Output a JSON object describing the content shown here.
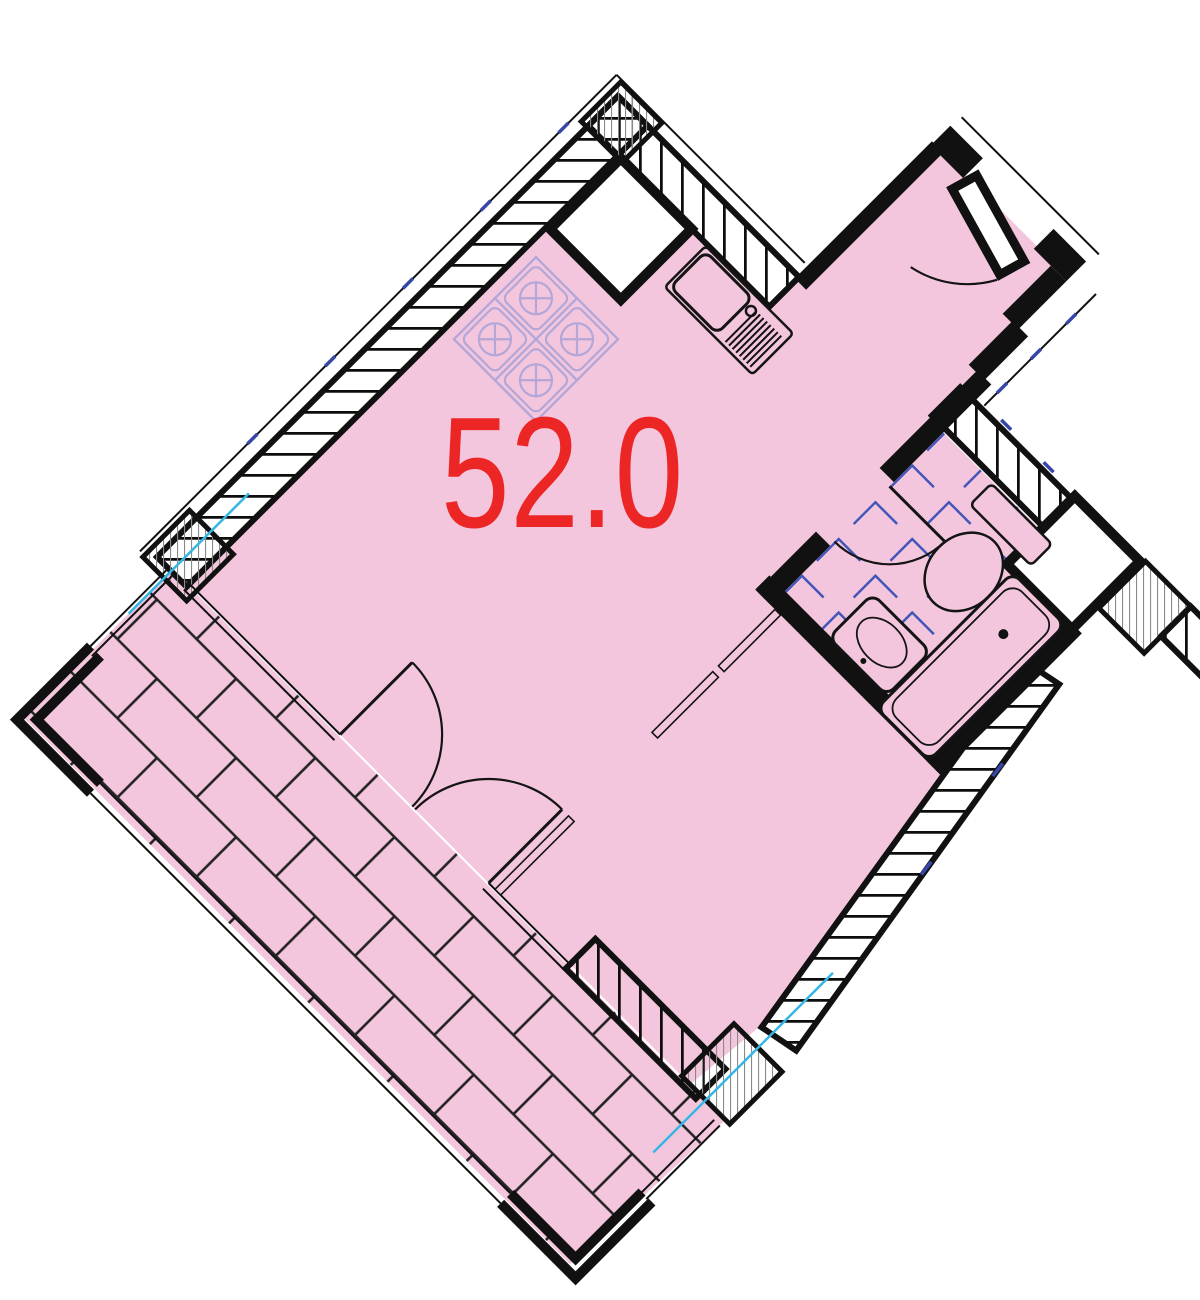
{
  "plan": {
    "area_label": "52.0",
    "rooms": [
      {
        "name": "living-room-kitchen",
        "area_label": "52.0"
      },
      {
        "name": "entrance-hall"
      },
      {
        "name": "bathroom"
      },
      {
        "name": "bedroom-area"
      },
      {
        "name": "balcony-terrace"
      }
    ],
    "fixtures": [
      "stove-4-burner",
      "kitchen-sink",
      "toilet",
      "bathtub",
      "washbasin"
    ],
    "doors": [
      "entrance-door",
      "bathroom-door",
      "balcony-double-doors"
    ],
    "colors": {
      "floor_pink": "#f4c6dd",
      "wall_black": "#111111",
      "label_red": "#ec2525",
      "tile_blue": "#4256b8",
      "tick_blue": "#3747a8",
      "stove_lavender": "#b2a7d8",
      "axis_cyan": "#35b6e4",
      "column_gray": "#8a8a8a",
      "brick_line": "#222222"
    }
  }
}
